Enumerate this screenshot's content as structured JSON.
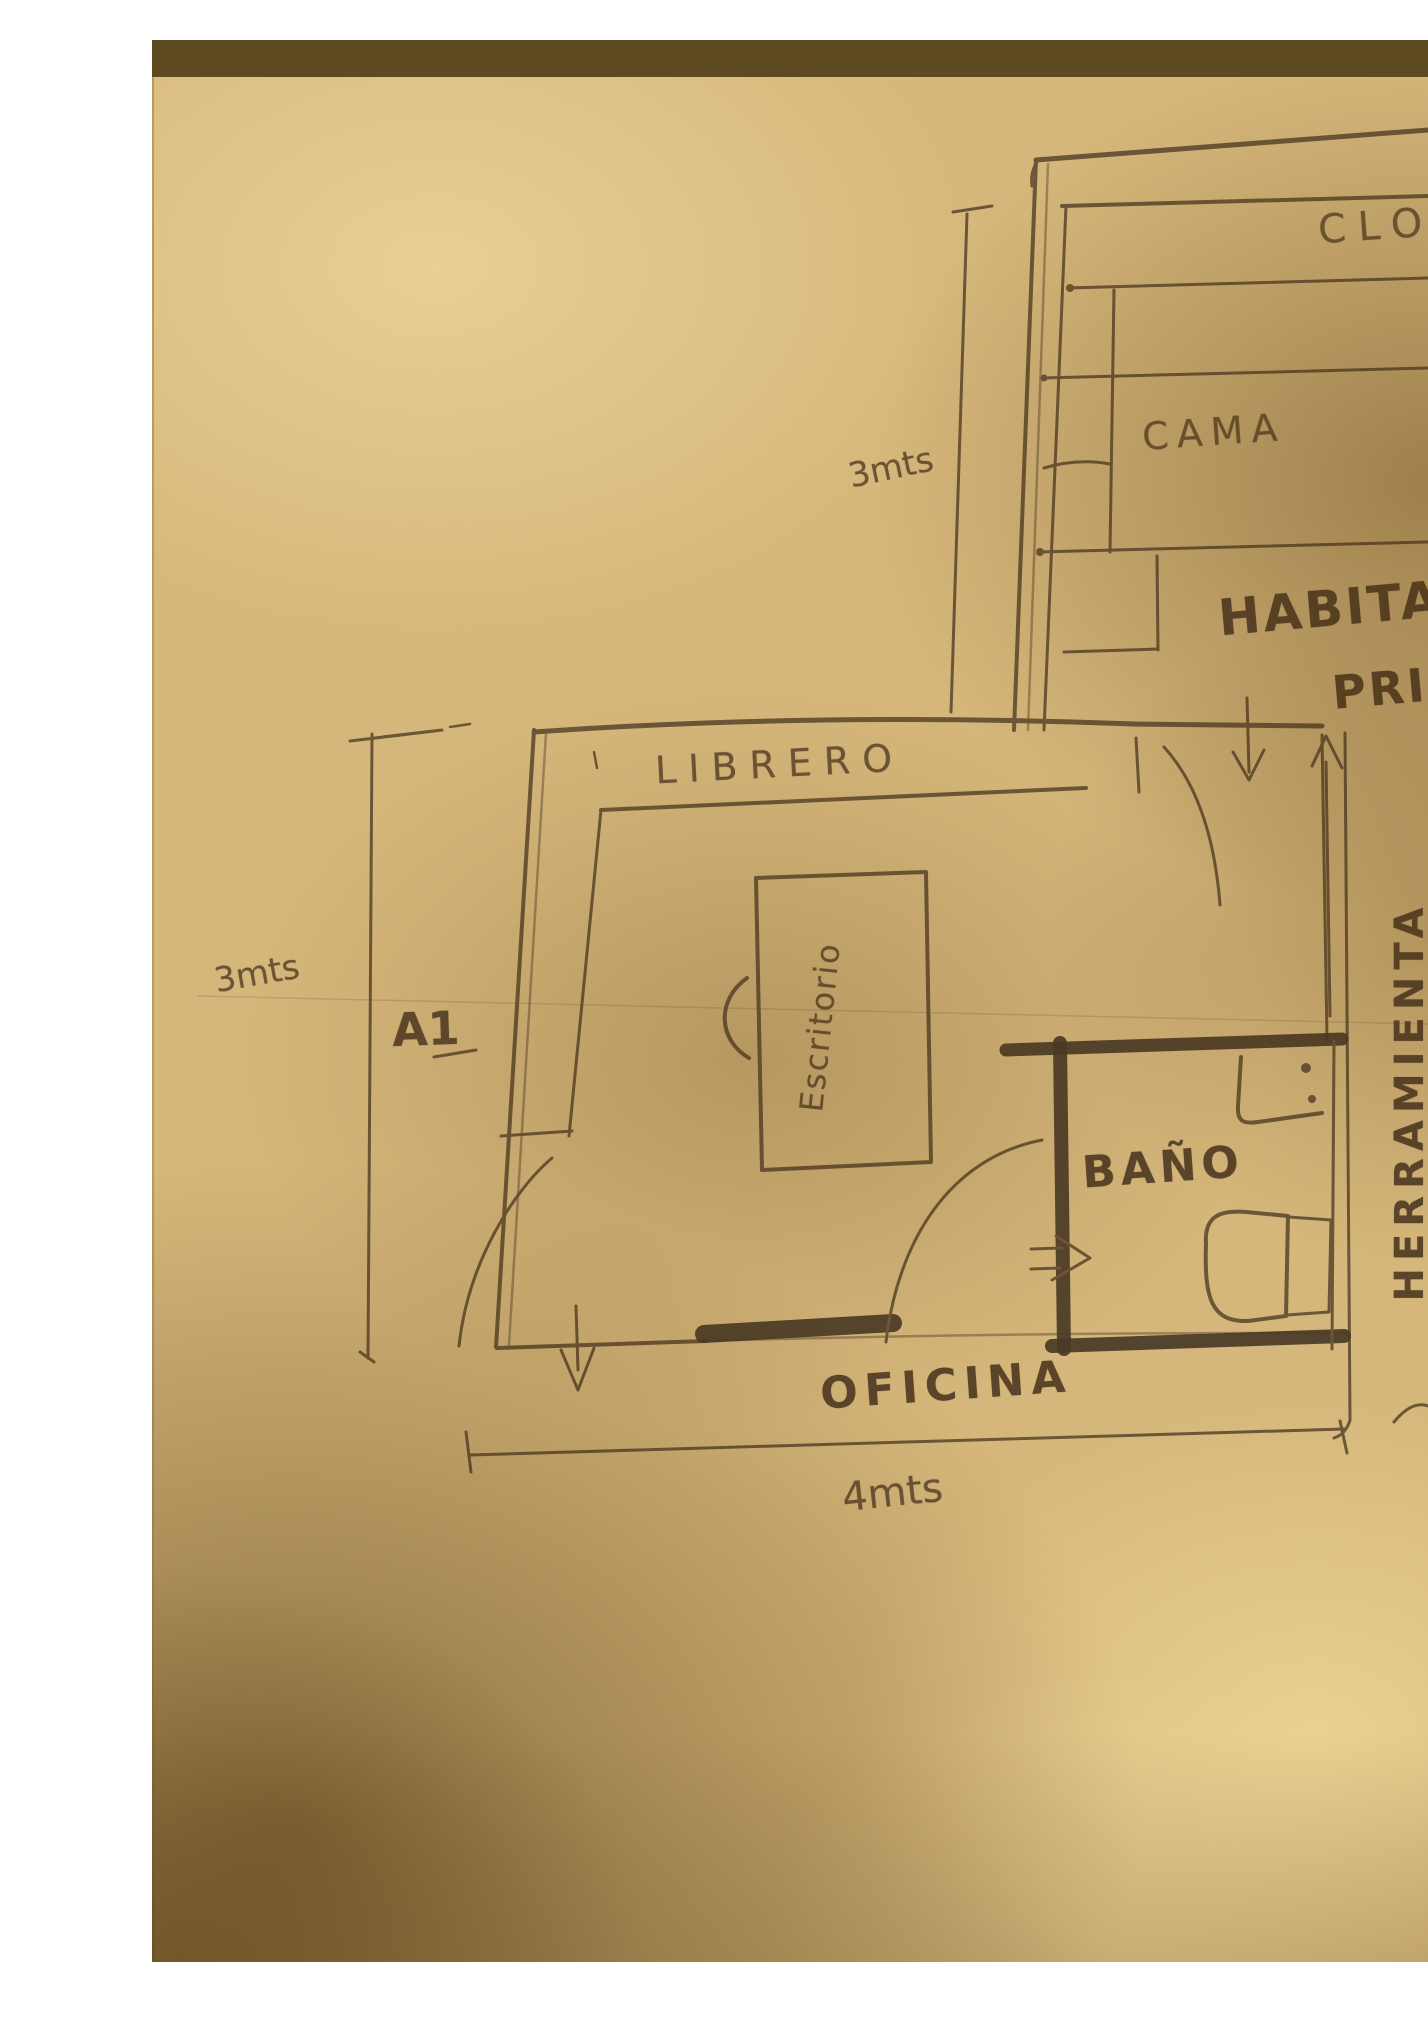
{
  "photo": {
    "type": "hand-drawn floor plan sketch, pencil on paper",
    "sheet_label": "A1"
  },
  "labels": {
    "closet": "CLOS",
    "bed": "CAMA",
    "bedroom_line1": "HABITAC",
    "bedroom_line2": "PRIN",
    "bookshelf": "LIBRERO",
    "desk": "Escritorio",
    "bathroom": "BAÑO",
    "tools_rack": "HERRAMIENTA",
    "office": "OFICINA"
  },
  "dimensions": {
    "bedroom_depth": "3mts",
    "office_depth": "3mts",
    "office_width": "4mts"
  },
  "palette": {
    "paper_lit": "#d8b87c",
    "paper_shadow": "#8f6b2e",
    "pencil": "#6b5637",
    "pencil_dark": "#4a3a26",
    "table_surface": "#6f5526",
    "margin": "#ffffff"
  }
}
